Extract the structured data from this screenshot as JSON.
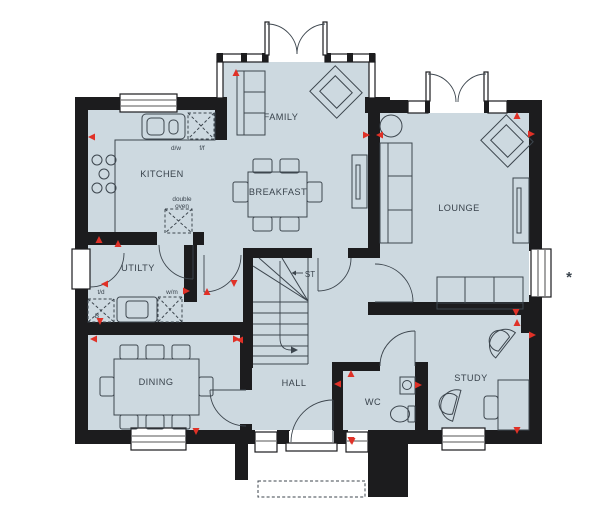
{
  "rooms": {
    "family": {
      "label": "FAMILY"
    },
    "kitchen": {
      "label": "KITCHEN"
    },
    "breakfast": {
      "label": "BREAKFAST"
    },
    "lounge": {
      "label": "LOUNGE"
    },
    "utility": {
      "label": "UTILTY"
    },
    "dining": {
      "label": "DINING"
    },
    "hall": {
      "label": "HALL"
    },
    "wc": {
      "label": "WC"
    },
    "study": {
      "label": "STUDY"
    },
    "store": {
      "label": "ST"
    }
  },
  "fixtures": {
    "dishwasher": {
      "label": "d/w"
    },
    "fridge_freezer": {
      "label": "f/f"
    },
    "double_oven": {
      "line1": "double",
      "line2": "oven"
    },
    "tumble_dryer": {
      "label": "t/d"
    },
    "washing_machine": {
      "label": "w/m"
    },
    "boiler": {
      "label": "B"
    }
  },
  "annotations": {
    "window_note": "*"
  },
  "colors": {
    "floor": "#cdd9e0",
    "wall": "#1c1c1e",
    "furniture_line": "#3d464e",
    "marker": "#e03127",
    "text": "#39434c"
  }
}
